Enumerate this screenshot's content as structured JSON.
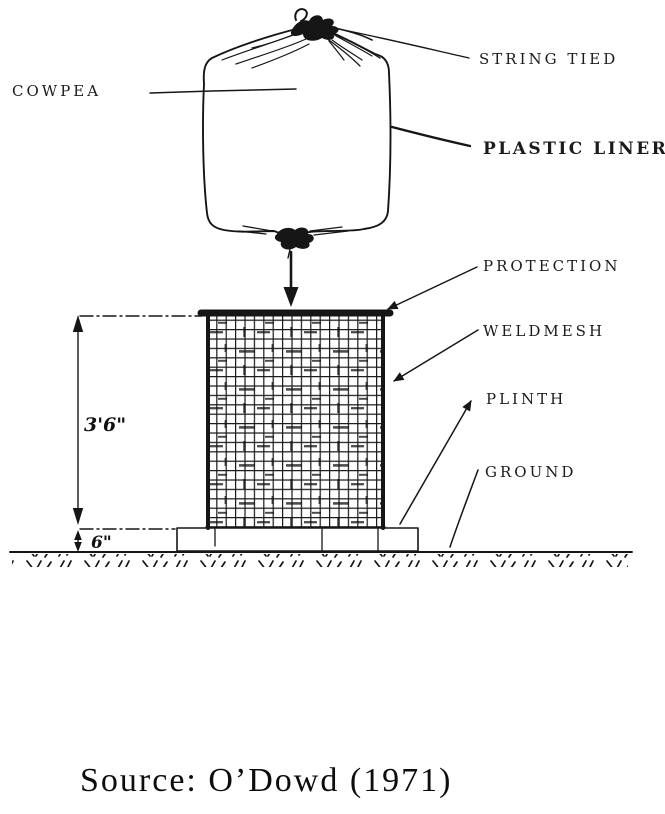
{
  "page": {
    "background": "#ffffff",
    "ink_color": "#161616"
  },
  "diagram": {
    "part_labels": {
      "cowpea": "COWPEA",
      "string_tied": "STRING TIED",
      "plastic_liner": "PLASTIC LINER",
      "protection": "PROTECTION",
      "weldmesh": "WELDMESH",
      "plinth": "PLINTH",
      "ground": "GROUND"
    },
    "dimensions": {
      "cage_height": "3'6\"",
      "plinth_height": "6\""
    },
    "source_caption": "Source: O’Dowd (1971)"
  }
}
